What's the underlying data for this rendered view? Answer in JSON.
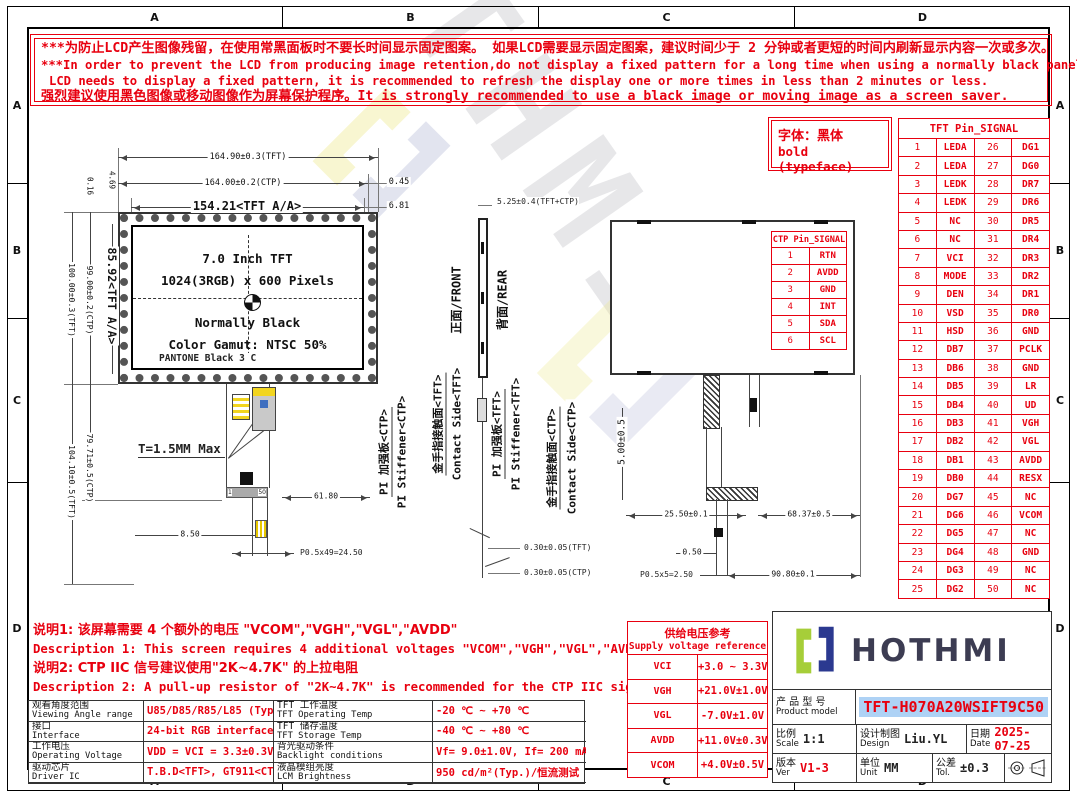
{
  "colors": {
    "red": "#e8000f",
    "navy": "#2b3990",
    "green": "#a6ce39",
    "highlight_blue": "#aed2f5",
    "line": "#333333",
    "watermark_yellow": "#eee98d"
  },
  "zones": {
    "letters": [
      "A",
      "B",
      "C",
      "D"
    ]
  },
  "watermark": {
    "text": "HOTHMI"
  },
  "warning": {
    "lines": [
      "***为防止LCD产生图像残留，在使用常黑面板时不要长时间显示固定图案。 如果LCD需要显示固定图案，建议时间少于 2 分钟或者更短的时间内刷新显示内容一次或多次。",
      "***In order to prevent the LCD from producing image retention,do not display a fixed pattern for a long time when using a normally black panel.If the",
      "LCD needs to display a fixed pattern, it is recommended to refresh the display one or more times in less than 2 minutes or less.",
      "强烈建议使用黑色图像或移动图像作为屏幕保护程序。It is strongly recommended to use a black image or moving image as a screen saver."
    ]
  },
  "typeface_note": {
    "line1": "字体：黑体",
    "line2": "bold (typeface)"
  },
  "front_view": {
    "line1": "7.0 Inch TFT",
    "line2": "1024(3RGB) x 600 Pixels",
    "line3": "Normally Black",
    "line4": "Color Gamut: NTSC 50%",
    "pantone": "PANTONE Black 3 C",
    "pin_first": "1",
    "pin_last": "50",
    "dims": {
      "tft_w": "164.90±0.3(TFT)",
      "ctp_w": "164.00±0.2(CTP)",
      "aa_w": "154.21<TFT A/A>",
      "d045": "0.45",
      "d681": "6.81",
      "aa_h": "85.92<TFT A/A>",
      "ctp_h": "99.00±0.2(CTP)",
      "tft_h": "100.00±0.3(TFT)",
      "ctp_total_h": "79.71±0.5(CTP)",
      "tft_total_h": "104.10±0.5(TFT)",
      "d016": "0.16",
      "d469": "4.69",
      "thickness": "T=1.5MM Max",
      "d6180": "61.80",
      "d850": "8.50",
      "pitch": "P0.5x49=24.50"
    },
    "fpc_labels": {
      "stiffener_zh": "PI 加强板<CTP>",
      "stiffener_en": "PI Stiffener<CTP>"
    }
  },
  "side_view": {
    "front_label": "正面/FRONT",
    "rear_label": "背面/REAR",
    "contact_tft_zh": "金手指接触面<TFT>",
    "contact_tft_en": "Contact Side<TFT>",
    "stiff_tft_zh": "PI 加强板<TFT>",
    "stiff_tft_en": "PI Stiffener<TFT>",
    "contact_ctp_zh": "金手指接触面<CTP>",
    "contact_ctp_en": "Contact Side<CTP>",
    "dims": {
      "total_t": "5.25±0.4(TFT+CTP)",
      "fpc_tft": "0.30±0.05(TFT)",
      "fpc_ctp": "0.30±0.05(CTP)"
    }
  },
  "rear_view": {
    "dims": {
      "d500": "5.00±0.5",
      "d2550": "25.50±0.1",
      "d6837": "68.37±0.5",
      "d050": "0.50",
      "pitch": "P0.5x5=2.50",
      "d9080": "90.80±0.1"
    }
  },
  "ctp_pin_table": {
    "title": "CTP Pin_SIGNAL",
    "rows": [
      [
        "1",
        "RTN"
      ],
      [
        "2",
        "AVDD"
      ],
      [
        "3",
        "GND"
      ],
      [
        "4",
        "INT"
      ],
      [
        "5",
        "SDA"
      ],
      [
        "6",
        "SCL"
      ]
    ]
  },
  "tft_pin_table": {
    "title": "TFT Pin_SIGNAL",
    "rows": [
      [
        "1",
        "LEDA",
        "26",
        "DG1"
      ],
      [
        "2",
        "LEDA",
        "27",
        "DG0"
      ],
      [
        "3",
        "LEDK",
        "28",
        "DR7"
      ],
      [
        "4",
        "LEDK",
        "29",
        "DR6"
      ],
      [
        "5",
        "NC",
        "30",
        "DR5"
      ],
      [
        "6",
        "NC",
        "31",
        "DR4"
      ],
      [
        "7",
        "VCI",
        "32",
        "DR3"
      ],
      [
        "8",
        "MODE",
        "33",
        "DR2"
      ],
      [
        "9",
        "DEN",
        "34",
        "DR1"
      ],
      [
        "10",
        "VSD",
        "35",
        "DR0"
      ],
      [
        "11",
        "HSD",
        "36",
        "GND"
      ],
      [
        "12",
        "DB7",
        "37",
        "PCLK"
      ],
      [
        "13",
        "DB6",
        "38",
        "GND"
      ],
      [
        "14",
        "DB5",
        "39",
        "LR"
      ],
      [
        "15",
        "DB4",
        "40",
        "UD"
      ],
      [
        "16",
        "DB3",
        "41",
        "VGH"
      ],
      [
        "17",
        "DB2",
        "42",
        "VGL"
      ],
      [
        "18",
        "DB1",
        "43",
        "AVDD"
      ],
      [
        "19",
        "DB0",
        "44",
        "RESX"
      ],
      [
        "20",
        "DG7",
        "45",
        "NC"
      ],
      [
        "21",
        "DG6",
        "46",
        "VCOM"
      ],
      [
        "22",
        "DG5",
        "47",
        "NC"
      ],
      [
        "23",
        "DG4",
        "48",
        "GND"
      ],
      [
        "24",
        "DG3",
        "49",
        "NC"
      ],
      [
        "25",
        "DG2",
        "50",
        "NC"
      ]
    ]
  },
  "notes": {
    "lines": [
      "说明1: 该屏幕需要 4 个额外的电压 \"VCOM\",\"VGH\",\"VGL\",\"AVDD\"",
      "Description 1: This screen requires 4 additional voltages \"VCOM\",\"VGH\",\"VGL\",\"AVDD\"",
      "说明2: CTP IIC 信号建议使用\"2K~4.7K\" 的上拉电阻",
      "Description 2: A pull-up resistor of \"2K~4.7K\" is recommended for the CTP IIC signal."
    ]
  },
  "supply_table": {
    "title_zh": "供给电压参考",
    "title_en": "Supply voltage reference",
    "rows": [
      {
        "name": "VCI",
        "value": "+3.0 ~ 3.3V"
      },
      {
        "name": "VGH",
        "value": "+21.0V±1.0V"
      },
      {
        "name": "VGL",
        "value": "-7.0V±1.0V"
      },
      {
        "name": "AVDD",
        "value": "+11.0V±0.3V"
      },
      {
        "name": "VCOM",
        "value": "+4.0V±0.5V"
      }
    ]
  },
  "spec_table": {
    "rows": [
      {
        "l1zh": "观看角度范围",
        "l1en": "Viewing Angle range",
        "v1": "U85/D85/R85/L85 (Typ.)",
        "l2zh": "TFT 工作温度",
        "l2en": "TFT Operating Temp",
        "v2": "-20 ℃ ~ +70 ℃"
      },
      {
        "l1zh": "接口",
        "l1en": "Interface",
        "v1": "24-bit RGB interface",
        "l2zh": "TFT 储存温度",
        "l2en": "TFT Storage Temp",
        "v2": "-40 ℃ ~ +80 ℃"
      },
      {
        "l1zh": "工作电压",
        "l1en": "Operating Voltage",
        "v1": "VDD = VCI = 3.3±0.3V",
        "l2zh": "背光驱动条件",
        "l2en": "Backlight conditions",
        "v2": "Vf= 9.0±1.0V, If= 200 mA"
      },
      {
        "l1zh": "驱动芯片",
        "l1en": "Driver IC",
        "v1": "T.B.D<TFT>, GT911<CTP>",
        "l2zh": "液晶模组亮度",
        "l2en": "LCM Brightness",
        "v2": "950 cd/m²(Typ.)/恒流测试"
      }
    ]
  },
  "title_block": {
    "brand": "HOTHMI",
    "model_zh": "产 品 型 号",
    "model_en": "Product model",
    "model_value": "TFT-H070A20WSIFT9C50",
    "scale_zh": "比例",
    "scale_en": "Scale",
    "scale_value": "1:1",
    "design_zh": "设计制图",
    "design_en": "Design",
    "design_value": "Liu.YL",
    "date_zh": "日期",
    "date_en": "Date",
    "date_value": "2025-07-25",
    "ver_zh": "版本",
    "ver_en": "Ver",
    "ver_value": "V1-3",
    "unit_zh": "单位",
    "unit_en": "Unit",
    "unit_value": "MM",
    "tol_zh": "公差",
    "tol_en": "Tol.",
    "tol_value": "±0.3"
  }
}
